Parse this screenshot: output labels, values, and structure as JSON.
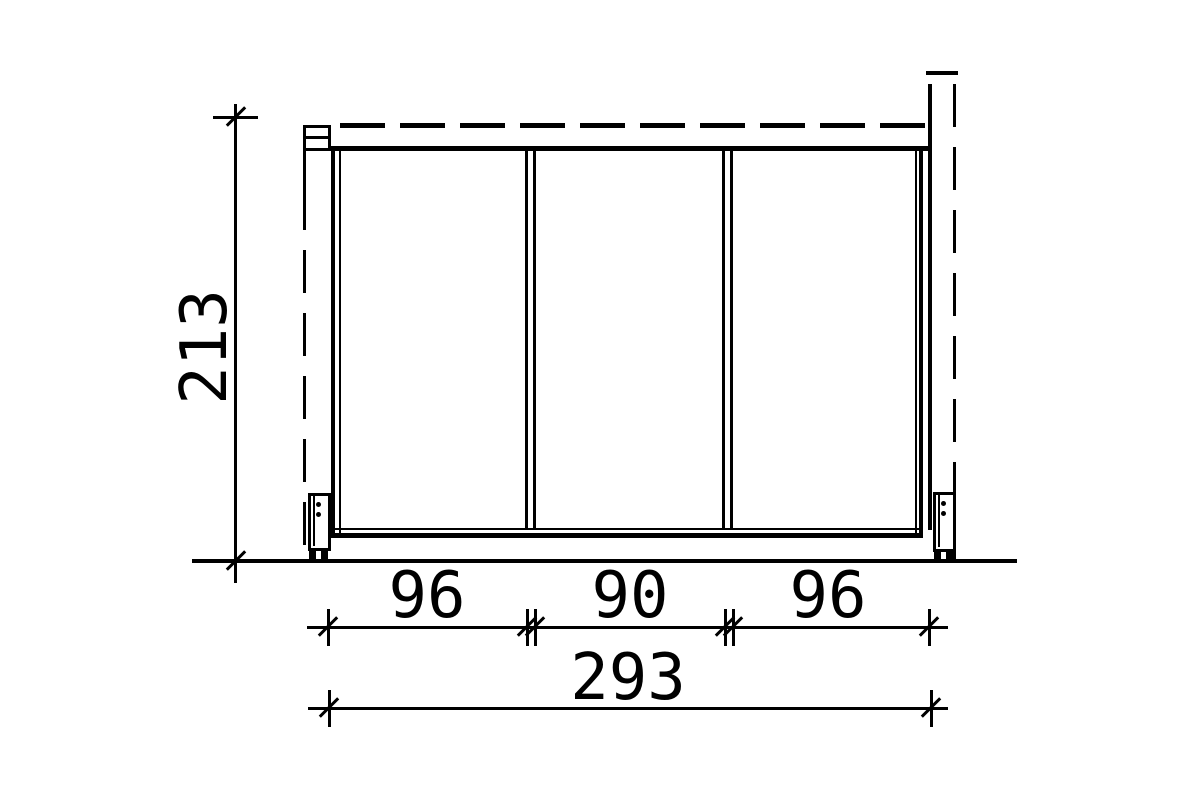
{
  "page": {
    "background_color": "#ffffff",
    "line_color": "#000000"
  },
  "drawing": {
    "type": "technical-elevation-side-wall",
    "panels": 3,
    "labels": {
      "height": "213",
      "segment_1": "96",
      "segment_2": "90",
      "segment_3": "96",
      "total_width": "293"
    }
  }
}
